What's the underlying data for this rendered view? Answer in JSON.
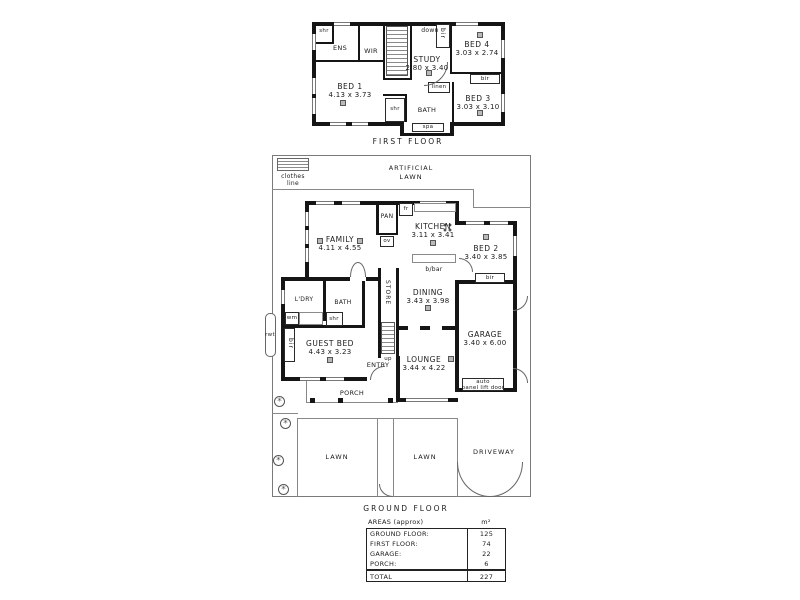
{
  "first_floor": {
    "caption": "FIRST FLOOR",
    "rooms": {
      "shr_closet": "shr",
      "ens": "ENS",
      "wir": "WIR",
      "study_name": "STUDY",
      "study_dim": "2.80 x 3.40",
      "bed4_name": "BED 4",
      "bed4_dim": "3.03 x 2.74",
      "bed1_name": "BED 1",
      "bed1_dim": "4.13 x 3.73",
      "bed3_name": "BED 3",
      "bed3_dim": "3.03 x 3.10",
      "bath": "BATH",
      "shr_bath": "shr",
      "spa": "spa",
      "linen": "linen",
      "bir_study": "bir",
      "bir_bed3": "bir",
      "down": "down"
    }
  },
  "ground_floor": {
    "caption": "GROUND FLOOR",
    "yard": {
      "clothes_line_1": "clothes",
      "clothes_line_2": "line",
      "artificial_lawn_1": "ARTIFICIAL",
      "artificial_lawn_2": "LAWN",
      "lawn_left": "LAWN",
      "lawn_right": "LAWN",
      "driveway": "DRIVEWAY",
      "rwt": "rwt"
    },
    "rooms": {
      "family_name": "FAMILY",
      "family_dim": "4.11 x 4.55",
      "kitchen_name": "KITCHEN",
      "kitchen_dim": "3.11 x 3.41",
      "pan": "PAN",
      "fridge": "fr",
      "oven": "ov",
      "bbar": "b/bar",
      "bed2_name": "BED 2",
      "bed2_dim": "3.40 x 3.85",
      "bir_bed2": "bir",
      "dining_name": "DINING",
      "dining_dim": "3.43 x 3.98",
      "garage_name": "GARAGE",
      "garage_dim": "3.40 x 6.00",
      "auto_door_1": "auto",
      "auto_door_2": "panel lift door",
      "ldry": "L'DRY",
      "bath": "BATH",
      "wm": "wm",
      "shr": "shr",
      "store": "STORE",
      "up": "up",
      "guest_name": "GUEST BED",
      "guest_dim": "4.43 x 3.23",
      "bir_guest": "bir",
      "entry": "ENTRY",
      "lounge_name": "LOUNGE",
      "lounge_dim": "3.44 x 4.22",
      "porch": "PORCH"
    }
  },
  "areas_table": {
    "header_label": "AREAS (approx)",
    "header_unit": "m²",
    "rows": [
      {
        "label": "GROUND FLOOR:",
        "value": "125"
      },
      {
        "label": "FIRST FLOOR:",
        "value": "74"
      },
      {
        "label": "GARAGE:",
        "value": "22"
      },
      {
        "label": "PORCH:",
        "value": "6"
      }
    ],
    "total_label": "TOTAL",
    "total_value": "227"
  },
  "colors": {
    "wall": "#151515",
    "line": "#888888",
    "text": "#1b1b1b"
  }
}
